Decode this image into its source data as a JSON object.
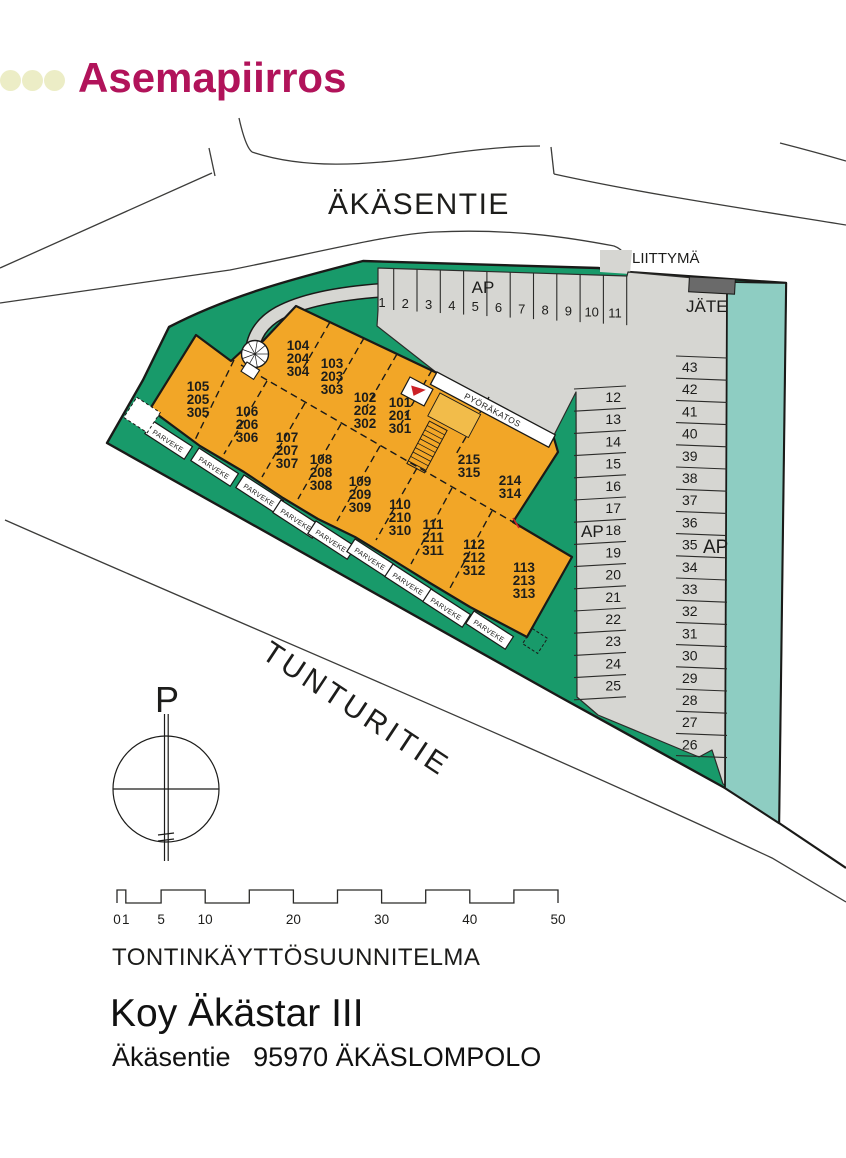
{
  "title": {
    "text": "Asemapiirros"
  },
  "roads": {
    "akasentie": "ÄKÄSENTIE",
    "tunturitie": "TUNTURITIE"
  },
  "site": {
    "liittyma": "LIITTYMÄ",
    "jate": "JÄTE",
    "ap": "AP",
    "pyorakatos": "PYÖRÄKATOS",
    "parveke": "PARVEKE",
    "north": "P"
  },
  "units": {
    "row_top": [
      {
        "lines": [
          "104",
          "204",
          "304"
        ],
        "x": 298,
        "y": 345
      },
      {
        "lines": [
          "103",
          "203",
          "303"
        ],
        "x": 332,
        "y": 363
      },
      {
        "lines": [
          "102",
          "202",
          "302"
        ],
        "x": 365,
        "y": 397
      },
      {
        "lines": [
          "101",
          "201",
          "301"
        ],
        "x": 400,
        "y": 402
      },
      {
        "lines": [
          "215",
          "315"
        ],
        "x": 469,
        "y": 459
      },
      {
        "lines": [
          "214",
          "314"
        ],
        "x": 510,
        "y": 480
      }
    ],
    "row_bottom": [
      {
        "lines": [
          "105",
          "205",
          "305"
        ],
        "x": 198,
        "y": 386
      },
      {
        "lines": [
          "106",
          "206",
          "306"
        ],
        "x": 247,
        "y": 411
      },
      {
        "lines": [
          "107",
          "207",
          "307"
        ],
        "x": 287,
        "y": 437
      },
      {
        "lines": [
          "108",
          "208",
          "308"
        ],
        "x": 321,
        "y": 459
      },
      {
        "lines": [
          "109",
          "209",
          "309"
        ],
        "x": 360,
        "y": 481
      },
      {
        "lines": [
          "110",
          "210",
          "310"
        ],
        "x": 400,
        "y": 504
      },
      {
        "lines": [
          "111",
          "211",
          "311"
        ],
        "x": 433,
        "y": 524
      },
      {
        "lines": [
          "112",
          "212",
          "312"
        ],
        "x": 474,
        "y": 544
      },
      {
        "lines": [
          "113",
          "213",
          "313"
        ],
        "x": 524,
        "y": 567
      }
    ]
  },
  "parking": {
    "top": [
      "1",
      "2",
      "3",
      "4",
      "5",
      "6",
      "7",
      "8",
      "9",
      "10",
      "11"
    ],
    "middle": [
      "12",
      "13",
      "14",
      "15",
      "16",
      "17",
      "18",
      "19",
      "20",
      "21",
      "22",
      "23",
      "24",
      "25"
    ],
    "right": [
      "43",
      "42",
      "41",
      "40",
      "39",
      "38",
      "37",
      "36",
      "35",
      "34",
      "33",
      "32",
      "31",
      "30",
      "29",
      "28",
      "27",
      "26"
    ]
  },
  "scalebar": {
    "values": [
      0,
      1,
      5,
      10,
      20,
      30,
      40,
      50
    ]
  },
  "footer": {
    "plan_type": "TONTINKÄYTTÖSUUNNITELMA",
    "company": "Koy Äkästar III",
    "address": "Äkäsentie   95970 ÄKÄSLOMPOLO"
  },
  "colors": {
    "accent": "#B1135A",
    "dot": "#ECEDC6",
    "green": "#189A6A",
    "teal": "#8ECDC2",
    "orange": "#F2A627",
    "orange_light": "#F2BC4A",
    "gray": "#D6D6D2",
    "dark_gray": "#6A6A6A",
    "red": "#CC2127",
    "line": "#1A1A18"
  }
}
